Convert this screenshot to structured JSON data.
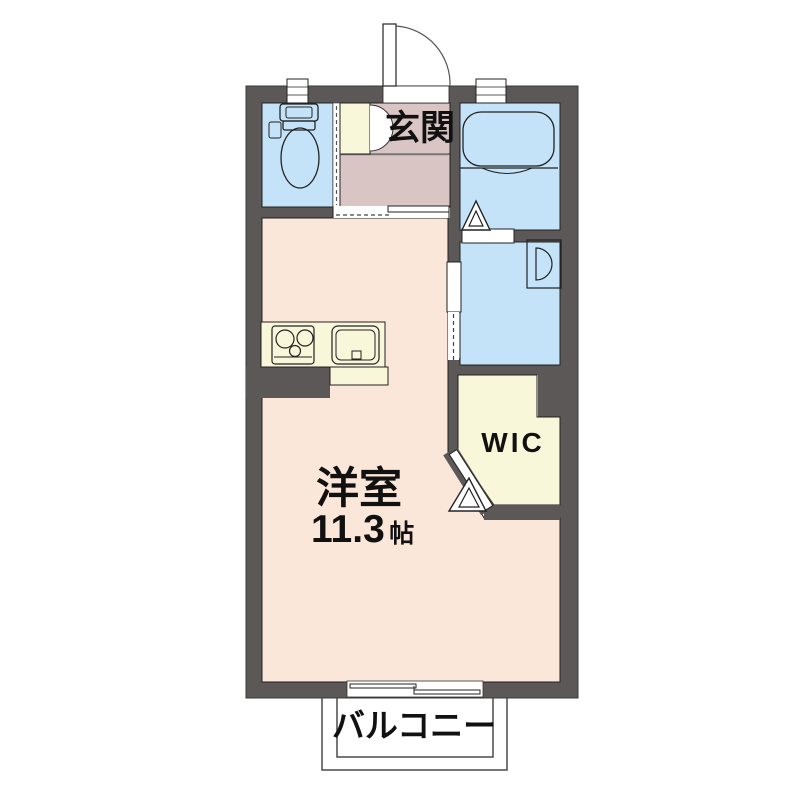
{
  "floor_plan": {
    "rooms": {
      "genkan": {
        "label": "玄関"
      },
      "main_room": {
        "label": "洋室",
        "size_value": "11.3",
        "size_unit": "帖"
      },
      "wic": {
        "label": "WIC"
      },
      "balcony": {
        "label": "バルコニー"
      }
    },
    "fixtures": [
      "entrance-swing-door",
      "toilet",
      "toilet-window",
      "closet-double-door",
      "bathtub",
      "bathroom-window",
      "bathroom-folding-door",
      "wash-basin",
      "washroom-sliding-door",
      "hall-sliding-door",
      "gas-stove",
      "kitchen-sink",
      "wic-folding-door",
      "balcony-sliding-window"
    ]
  },
  "colors": {
    "background": "#ffffff",
    "wall": "#5b5857",
    "main_room": "#fbe7d9",
    "entrance_hall": "#d9c5c4",
    "wet_area": "#c5e3f8",
    "storage": "#f9f7d9",
    "outline": "#222222"
  }
}
